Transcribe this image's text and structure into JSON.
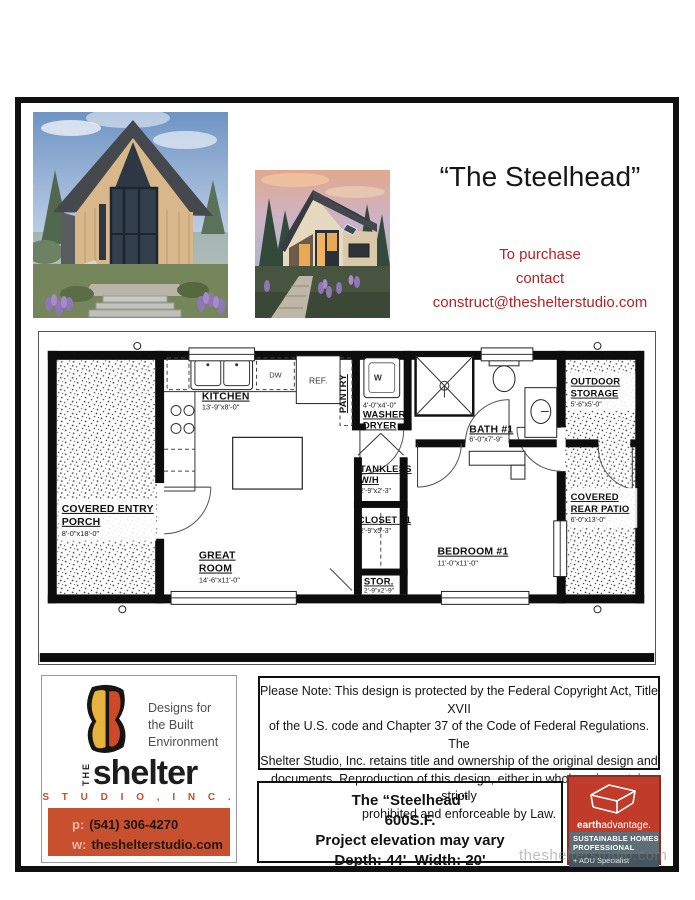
{
  "header": {
    "title": "“The Steelhead”",
    "purchase": {
      "line1": "To purchase",
      "line2": "contact",
      "email": "construct@theshelterstudio.com"
    }
  },
  "plan": {
    "kitchen": {
      "n": "KITCHEN",
      "d": "13'-9\"x8'-0\""
    },
    "great_room": {
      "n1": "GREAT",
      "n2": "ROOM",
      "d": "14'-6\"x11'-0\""
    },
    "porch": {
      "n1": "COVERED ENTRY",
      "n2": "PORCH",
      "d": "8'-0\"x18'-0\""
    },
    "washer_dryer": {
      "n1": "WASHER/",
      "n2": "DRYER",
      "d": "4'-0\"x4'-0\"",
      "unit": "W"
    },
    "pantry": {
      "n": "PANTRY"
    },
    "ref": {
      "n": "REF."
    },
    "dw": {
      "n": "DW"
    },
    "bath": {
      "n": "BATH #1",
      "d": "6'-0\"x7'-9\""
    },
    "tankless": {
      "n1": "TANKLESS",
      "n2": "W/H",
      "d": "2'-9\"x2'-3\""
    },
    "closet": {
      "n": "CLOSET #1",
      "d": "2'-9\"x5'-3\""
    },
    "stor": {
      "n": "STOR.",
      "d": "2'-9\"x2'-9\""
    },
    "bedroom": {
      "n": "BEDROOM #1",
      "d": "11'-0\"x11'-0\""
    },
    "storage": {
      "n1": "OUTDOOR",
      "n2": "STORAGE",
      "d": "5'-6\"x5'-0\""
    },
    "patio": {
      "n1": "COVERED",
      "n2": "REAR PATIO",
      "d": "6'-0\"x13'-0\""
    }
  },
  "shelter_card": {
    "tagline": {
      "line1": "Designs for",
      "line2": "the Built",
      "line3": "Environment"
    },
    "the": "THE",
    "name": "shelter",
    "studio": "S T U D I O ,   I N C .",
    "phone_prefix": "p:",
    "phone": "(541) 306-4270",
    "web_prefix": "w:",
    "web": "theshelterstudio.com"
  },
  "copyright": {
    "lines": [
      "Please Note: This design is protected by the Federal Copyright Act, Title XVII",
      "of the U.S.  code and Chapter 37 of the Code of Federal Regulations.  The",
      "Shelter Studio, Inc. retains title and ownership of the original design and",
      "documents.  Reproduction of this design, either in whole or in part, is strictly",
      "prohibited and enforceable by Law."
    ]
  },
  "info_box": {
    "lines": [
      "The “Steelhead”",
      "600S.F.",
      "Project elevation may vary",
      "Depth: 44'  Width: 20'"
    ]
  },
  "earth_advantage": {
    "brand_bold": "earth",
    "brand_rest": "advantage.",
    "band1a": "SUSTAINABLE HOMES",
    "band1b": "PROFESSIONAL",
    "band2": "+ ADU Specialist"
  },
  "watermark": "theshelterstudio.com"
}
